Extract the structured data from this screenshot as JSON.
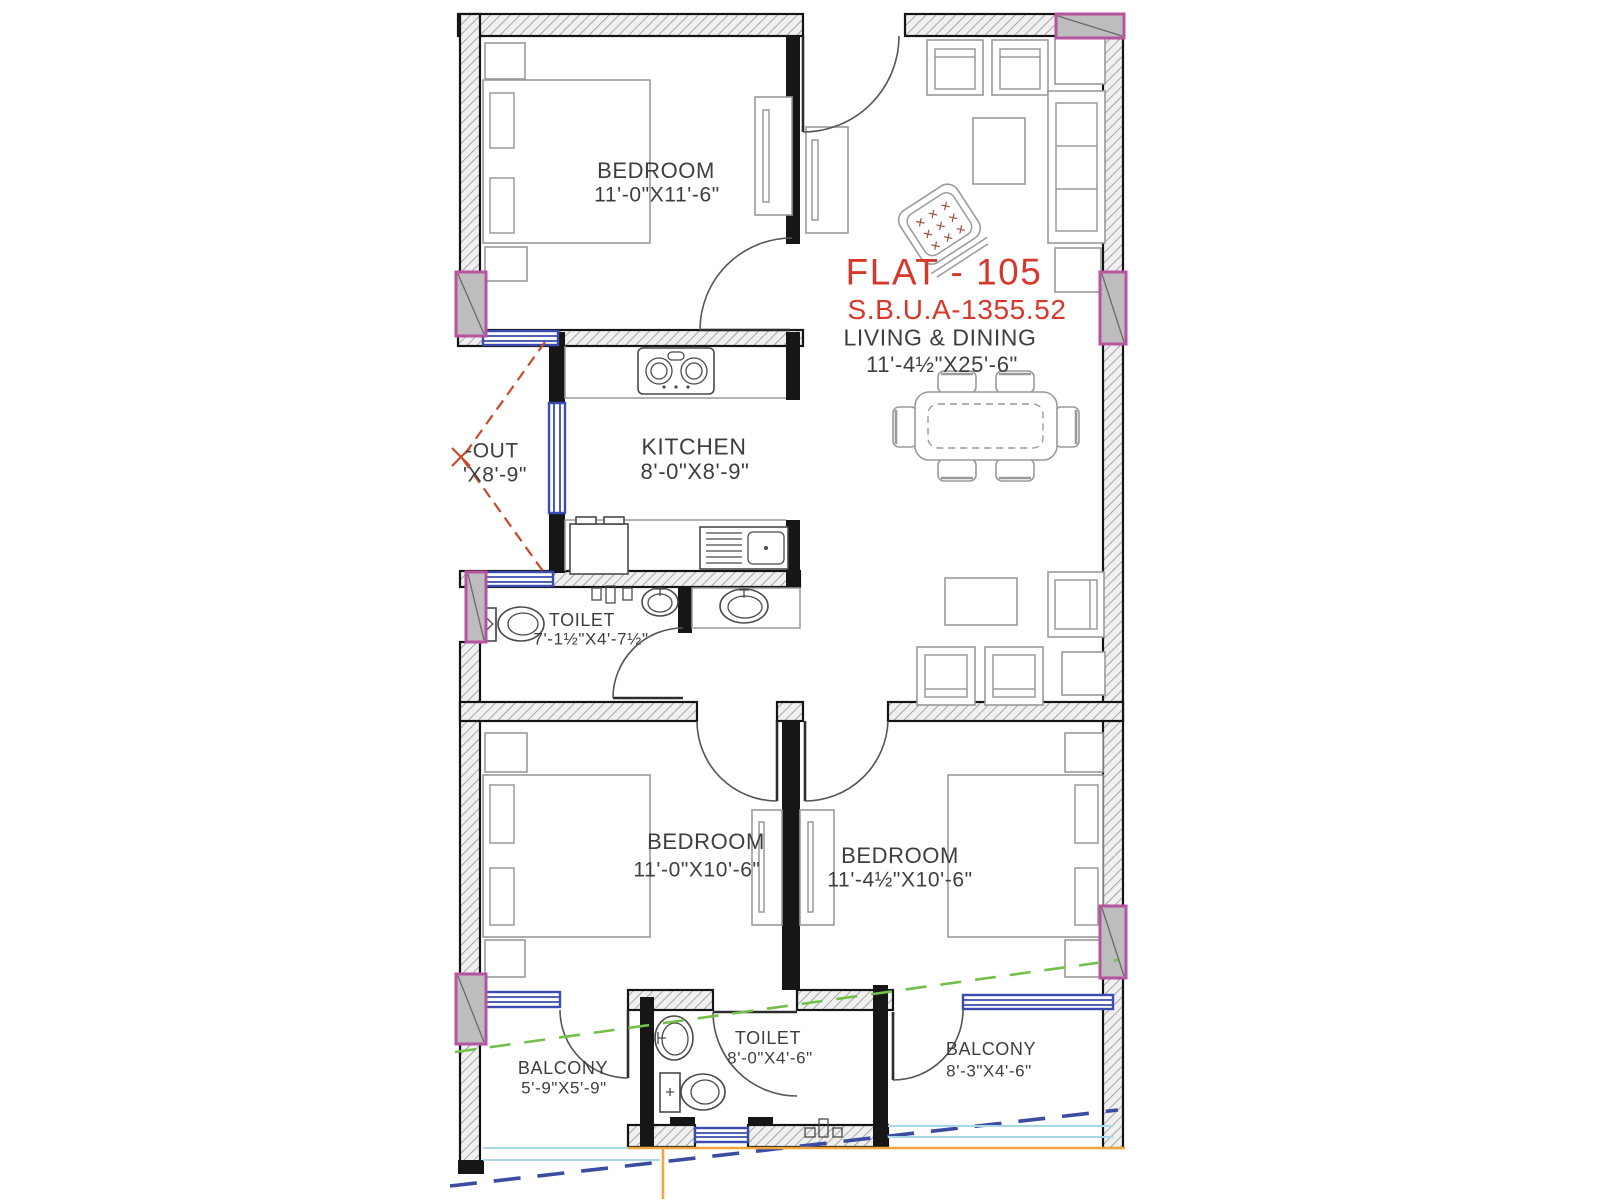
{
  "plan_title": {
    "flat": "FLAT - 105",
    "sbua": "S.B.U.A-1355.52"
  },
  "rooms": {
    "bedroom_top": {
      "name": "BEDROOM",
      "dims": "11'-0\"X11'-6\""
    },
    "living_dining": {
      "name": "LIVING & DINING",
      "dims": "11'-4½\"X25'-6\""
    },
    "kitchen": {
      "name": "KITCHEN",
      "dims": "8'-0\"X8'-9\""
    },
    "cutout": {
      "name": "-OUT",
      "dims": "'X8'-9\""
    },
    "toilet_mid": {
      "name": "TOILET",
      "dims": "7'-1½\"X4'-7½\""
    },
    "bedroom_left": {
      "name": "BEDROOM",
      "dims": "11'-0\"X10'-6\""
    },
    "bedroom_right": {
      "name": "BEDROOM",
      "dims": "11'-4½\"X10'-6\""
    },
    "balcony_left": {
      "name": "BALCONY",
      "dims": "5'-9\"X5'-9\""
    },
    "toilet_bottom": {
      "name": "TOILET",
      "dims": "8'-0\"X4'-6\""
    },
    "balcony_right": {
      "name": "BALCONY",
      "dims": "8'-3\"X4'-6\""
    }
  },
  "colors": {
    "accent_red": "#d6392c",
    "text_dark": "#3f3e3e",
    "wall_dark": "#161616",
    "window_blue": "#3a4cb0",
    "column_purple": "#b853a0",
    "column_gray": "#bdbdbd",
    "furniture_gray": "#9a9a9a",
    "fixture_gray": "#4a4a4a",
    "green_dash": "#74c04c",
    "navy_dash": "#3b4da3",
    "cyan_line": "#a6d8e6",
    "orange_line": "#f0a63c",
    "cutout_red": "#c84a2e"
  }
}
